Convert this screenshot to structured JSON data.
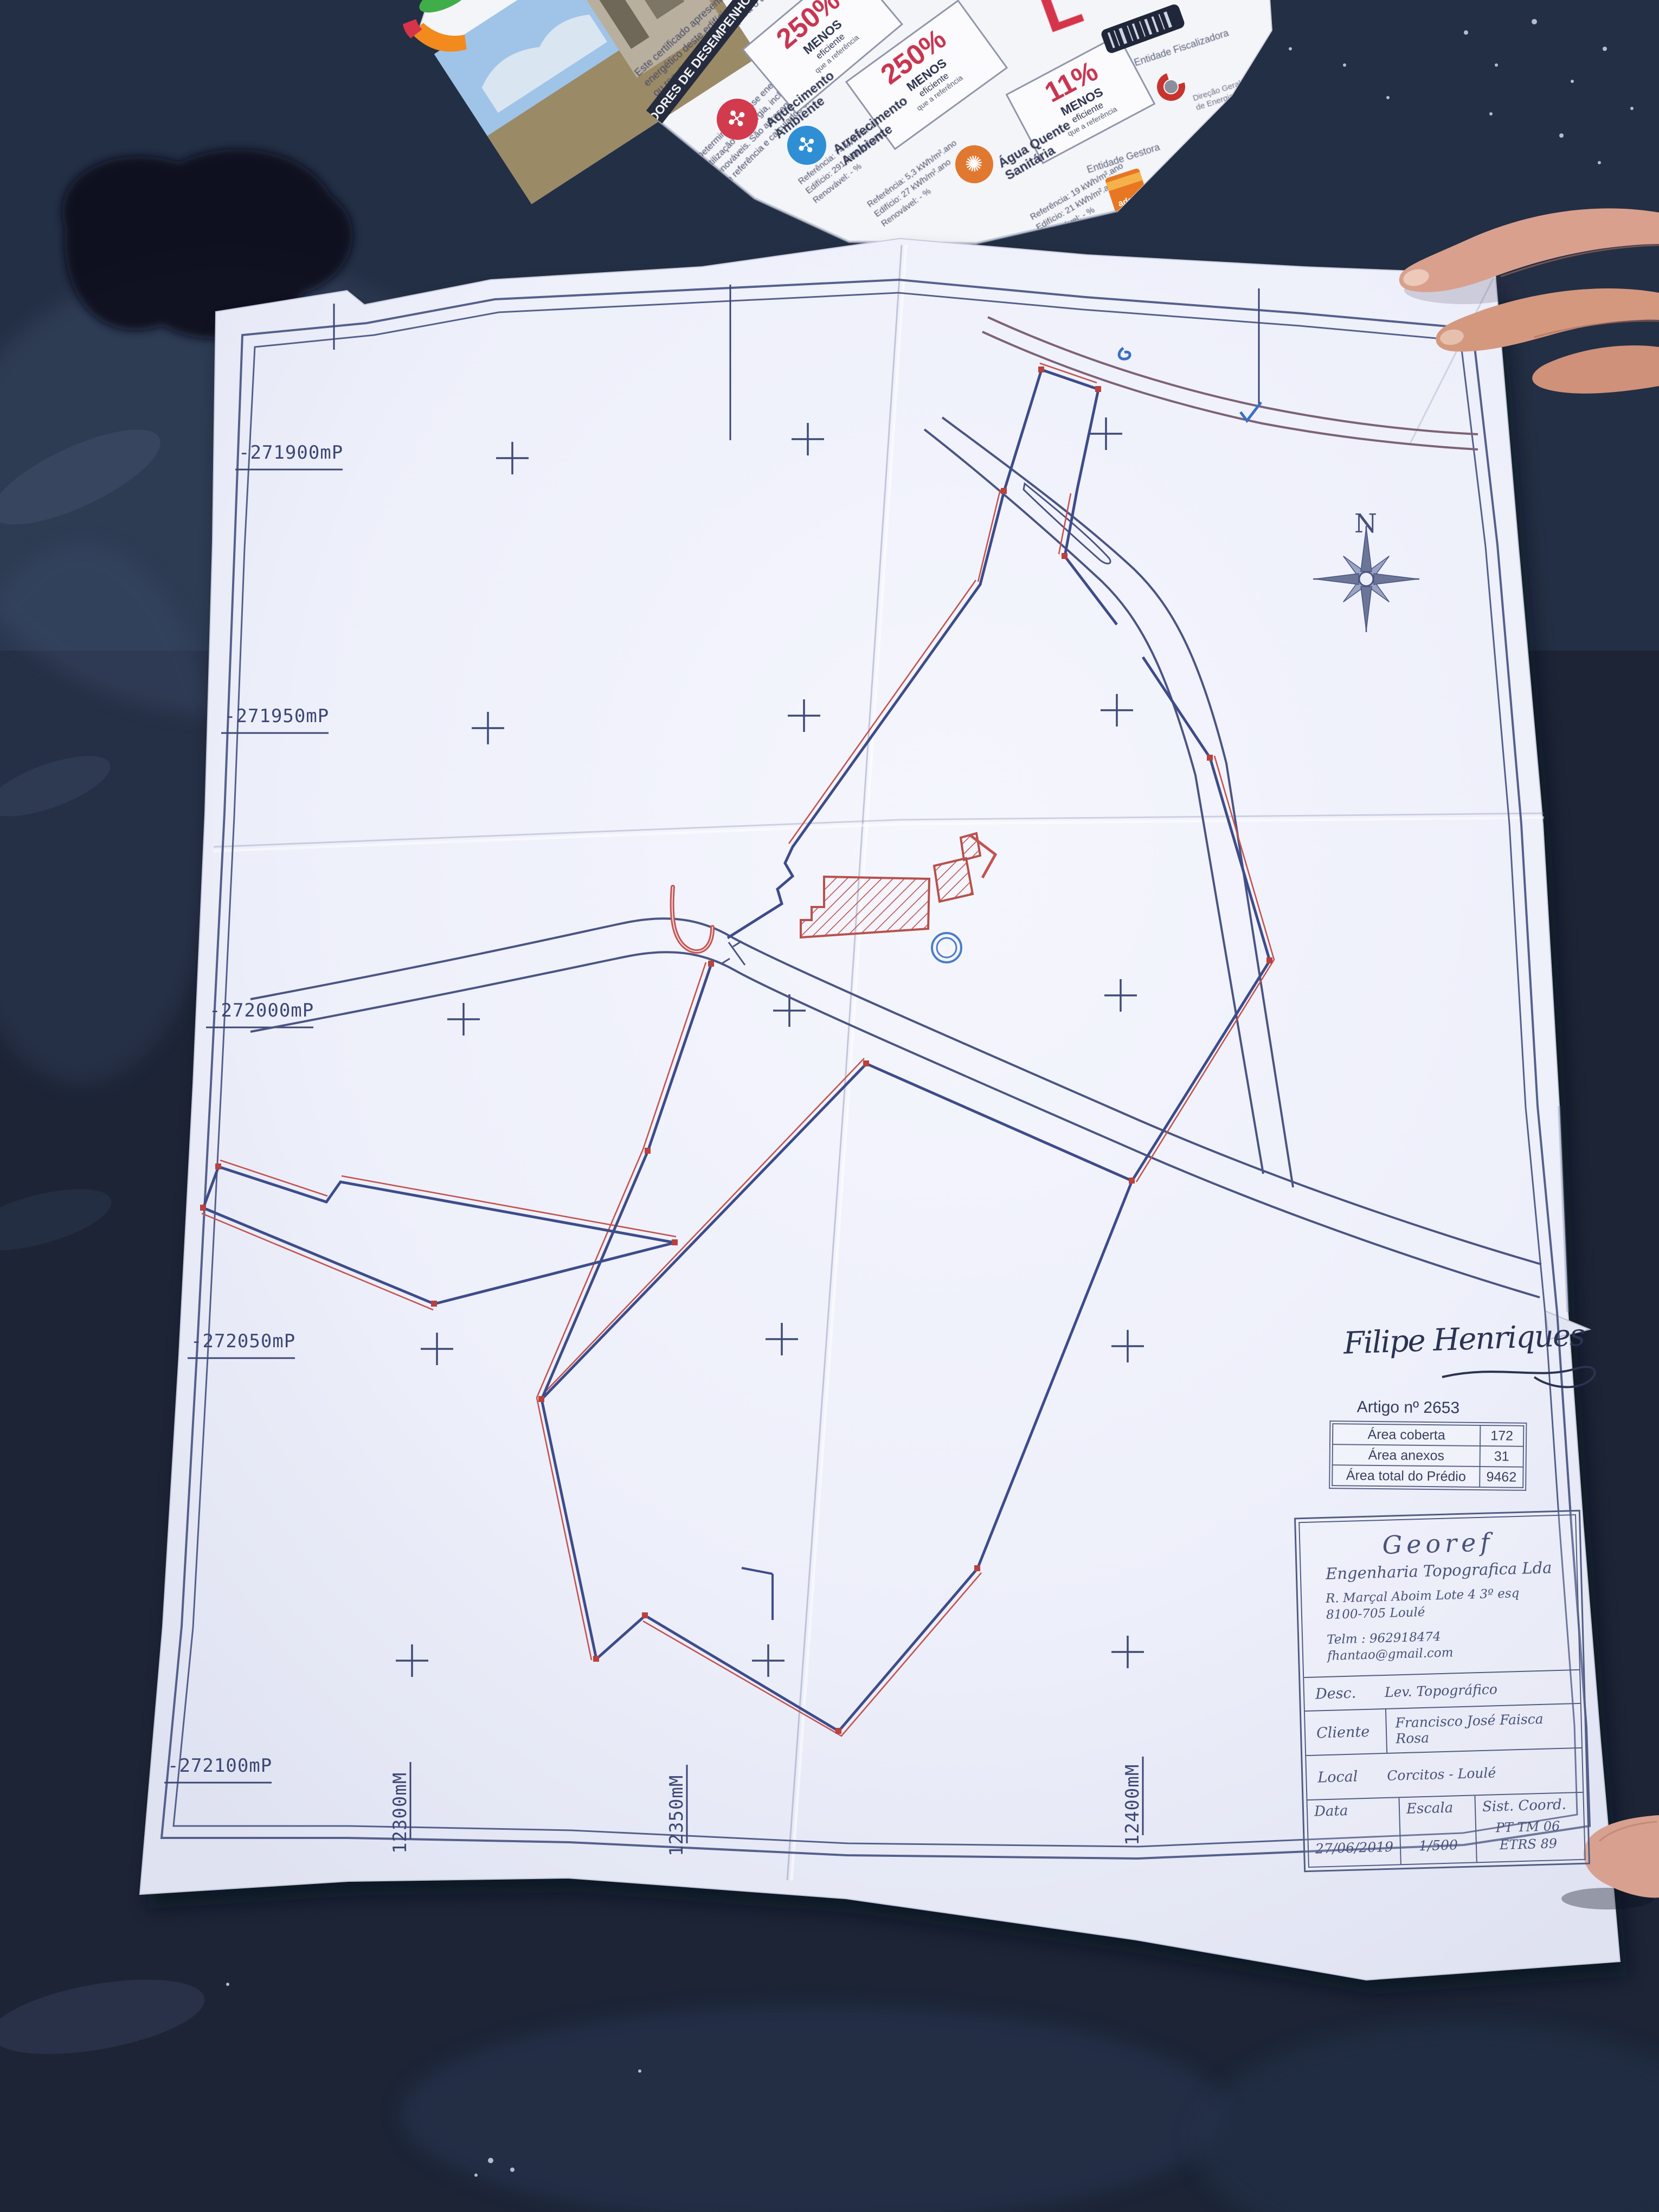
{
  "colors": {
    "table": "#1c2436",
    "paper": "#edeffa",
    "line_navy": "#3d4c8a",
    "line_red": "#c4524e",
    "badge_red": "#c9304a",
    "fan_red": "#d23b4e",
    "fan_blue": "#2f8fd4",
    "aqs_orange": "#e07830",
    "adene_orange": "#e87722",
    "skin": "#d9a08e"
  },
  "plan": {
    "grid_labels_left": [
      "-271900mP",
      "-271950mP",
      "-272000mP",
      "-272050mP",
      "-272100mP"
    ],
    "grid_labels_bottom": [
      "12300mM",
      "12350mM",
      "12400mM"
    ],
    "compass_label": "N",
    "signature": "Filipe Henriques",
    "artigo": {
      "title": "Artigo nº 2653",
      "rows": [
        {
          "label": "Área coberta",
          "value": "172"
        },
        {
          "label": "Área anexos",
          "value": "31"
        },
        {
          "label": "Área total do Prédio",
          "value": "9462"
        }
      ]
    },
    "title_block": {
      "company": "Georef",
      "company_subtitle": "Engenharia Topografica Lda",
      "address1": "R. Marçal Aboim Lote 4 3º esq",
      "address2": "8100-705 Loulé",
      "phone": "Telm : 962918474",
      "email": "fhantao@gmail.com",
      "desc_label": "Desc.",
      "desc_value": "Lev. Topográfico",
      "client_label": "Cliente",
      "client_value": "Francisco José Faisca Rosa",
      "local_label": "Local",
      "local_value": "Corcitos - Loulé",
      "date_label": "Data",
      "date_value": "27/06/2019",
      "scale_label": "Escala",
      "scale_value": "1/500",
      "coord_label": "Sist. Coord.",
      "coord_value_line1": "PT TM 06",
      "coord_value_line2": "ETRS 89"
    }
  },
  "brochure": {
    "intro_lines": [
      "Este certificado apresenta a cl…",
      "energético deste edifício nas con…",
      "ou requisitos aplicáveis para o an…"
    ],
    "band_title": "INDICADORES DE DESEMPENHO",
    "para2_lines": [
      "Determinam a classe energética do edif…",
      "utilização de energia, incluindo o co…",
      "renováveis. São apresentados comparativ…",
      "de referência e calculados em condições p…"
    ],
    "indicators": [
      {
        "name_line1": "Aquecimento",
        "name_line2": "Ambiente",
        "row1": "Referência:  74 kWh/m².ano",
        "row2": "Edifício:  291 kWh/m².ano",
        "row3": "Renovável:  - %",
        "badge_pct": "250%",
        "badge_l1": "MENOS",
        "badge_l2": "eficiente",
        "badge_l3": "que a referência"
      },
      {
        "name_line1": "Arrefecimento",
        "name_line2": "Ambiente",
        "row1": "Referência:  5,3 kWh/m².ano",
        "row2": "Edifício:  27 kWh/m².ano",
        "row3": "Renovável:  - %",
        "badge_pct": "250%",
        "badge_l1": "MENOS",
        "badge_l2": "eficiente",
        "badge_l3": "que a referência"
      },
      {
        "name_line1": "Água Quente",
        "name_line2": "Sanitária",
        "row1": "Referência:  19 kWh/m².ano",
        "row2": "Edifício:  21 kWh/m².ano",
        "row3": "Renovável:  - %",
        "badge_pct": "11%",
        "badge_l1": "MENOS",
        "badge_l2": "eficiente",
        "badge_l3": "que a referência"
      }
    ],
    "entity_1_label": "Entidade Fiscalizadora",
    "entity_1_name_line1": "Direção Geral",
    "entity_1_name_line2": "de Energia e Geologia",
    "entity_2_label": "Entidade Gestora",
    "entity_2_name": "adene",
    "entity_2_sub": "Agência para a Energia"
  }
}
